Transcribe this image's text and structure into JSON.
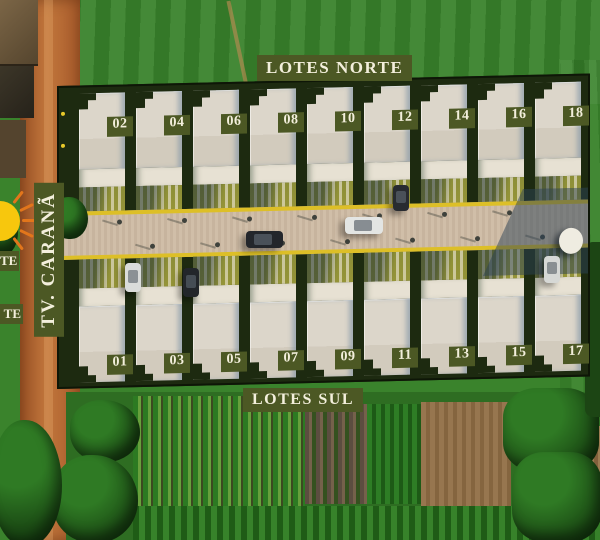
{
  "plan": {
    "area_label_north": "LOTES NORTE",
    "area_label_south": "LOTES SUL",
    "street_label": "TV. CARANÃ",
    "edge_label_top_partial": "TE",
    "edge_label_bottom_partial": "TE"
  },
  "lots": {
    "north": [
      "02",
      "04",
      "06",
      "08",
      "10",
      "12",
      "14",
      "16",
      "18"
    ],
    "south": [
      "01",
      "03",
      "05",
      "07",
      "09",
      "11",
      "13",
      "15",
      "17"
    ]
  },
  "icons": {
    "sun": "half-sun-with-rays",
    "street_lamp": "lamp-post-dot",
    "water_tank": "round-white-tank",
    "cars": [
      "dark-car-on-street",
      "silver-car-on-street",
      "white-car-parked-south",
      "dark-car-parked-south",
      "dark-car-parked-north",
      "white-car-parked-south-east"
    ]
  },
  "colors": {
    "badge_bg": "#4c5824",
    "badge_text": "#f3efdc",
    "pavement": "#cdbaa3",
    "curb_yellow": "#ddbf27",
    "roof": "#d9d3c7",
    "grass": "#3a832c",
    "dirt_road": "#b4632f",
    "hedge_dark": "#1d2a10",
    "tree_dark": "#1c4514",
    "field_brown": "#97764f",
    "sun_core": "#f7c70d",
    "sun_rays": "#e2761b",
    "shadow_blue": "#2c4255"
  }
}
